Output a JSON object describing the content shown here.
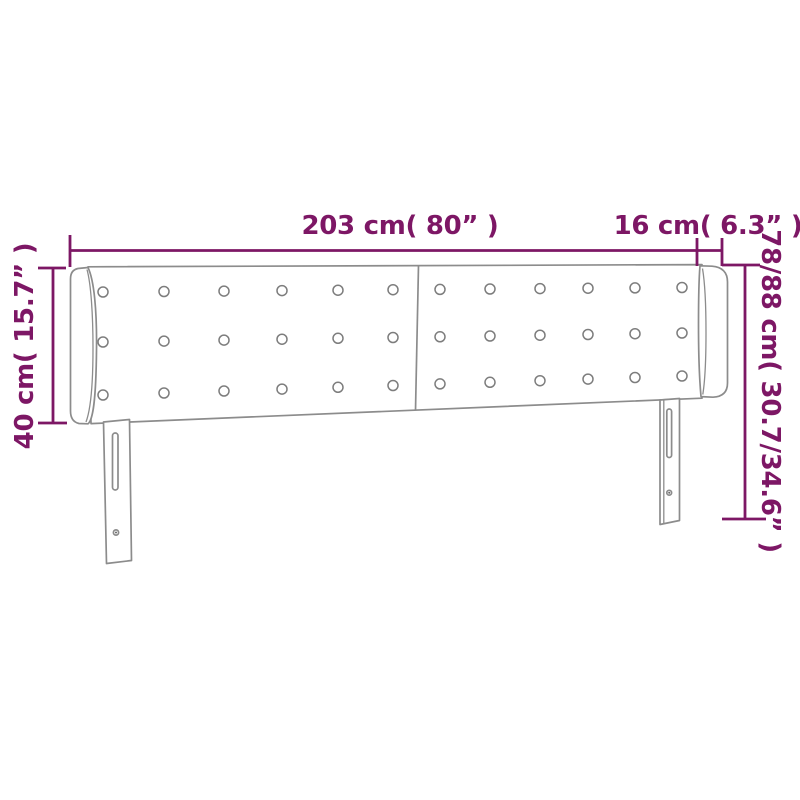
{
  "diagram": {
    "subject": "button-tufted headboard with side ears and two mounting legs",
    "labels": {
      "width": "203 cm( 80” )",
      "ear_depth": "16 cm( 6.3” )",
      "ear_height": "40 cm( 15.7” )",
      "total_height": "78/88 cm( 30.7/34.6” )"
    },
    "colors": {
      "dimension": "#7D1765",
      "outline": "#8C8C8C",
      "background": "#FFFFFF"
    }
  }
}
